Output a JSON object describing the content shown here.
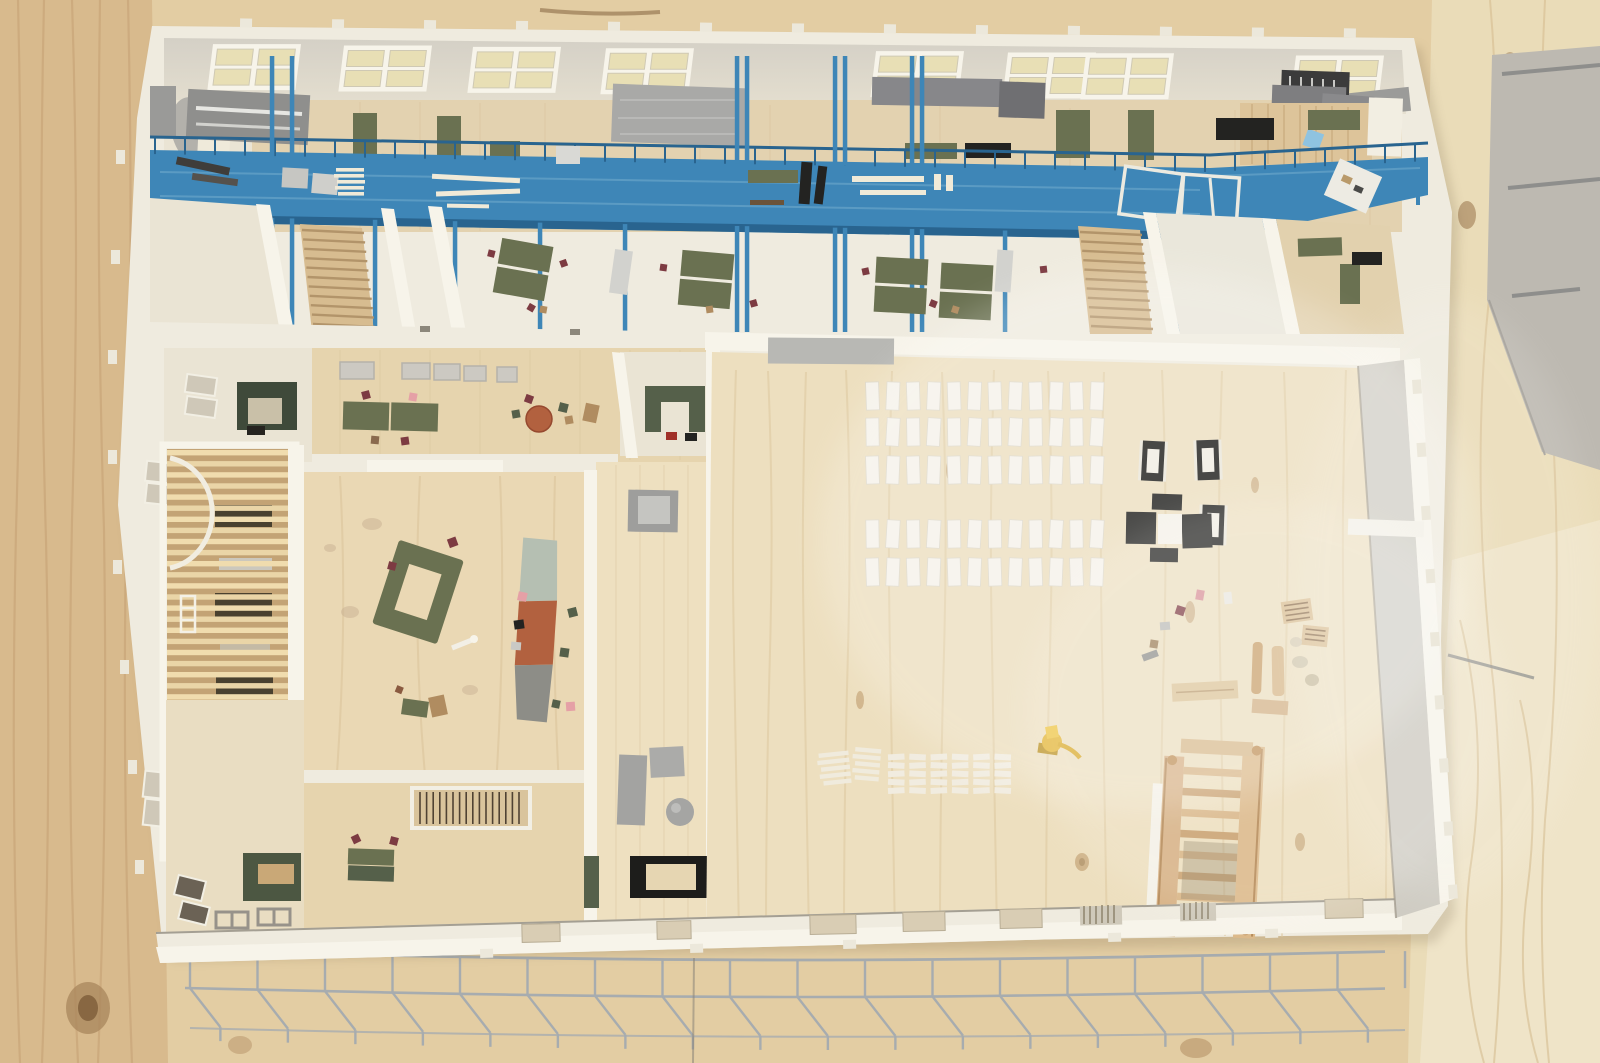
{
  "scene": {
    "subject": "architectural scale model of an elongated building, photographed top-down",
    "setting": "model laid on a knotty pine work table, gray mat-board sheet and metal rods at upper right, welded wire truss along the bottom edge",
    "palette": {
      "table": "#e3cda3",
      "table_left": "#d8ba8d",
      "table_right": "#eadcb8",
      "table_pale": "#efe4c8",
      "grain": "#c19a6e",
      "wall": "#efebdf",
      "wall_bright": "#f7f4ea",
      "wall_shadow": "#d8d3c4",
      "floor": "#e6d4ae",
      "floor_pale": "#eee0c0",
      "floor_white": "#eae4d4",
      "ceiling": "#d8d4ca",
      "skylight": "#e8dfb5",
      "blue": "#3e86b7",
      "blue_dark": "#29648f",
      "blue_light": "#6fa9cc",
      "olive": "#6a7151",
      "olive_dark": "#55604a",
      "gray_box": "#a6a6a3",
      "gray_dark": "#84848a",
      "gray_face": "#cfccc3",
      "black": "#232321",
      "terracotta": "#b2613f",
      "sage": "#b5bfb2",
      "counter_gray": "#8d8d87",
      "red_chair": "#7d3b42",
      "pink": "#e5a0a6",
      "tan": "#b08c60",
      "truss": "#a7acaf",
      "stair_wood": "#d7b286",
      "stair_wood_dark": "#b58a58",
      "yellow": "#e2b22e",
      "board": "#bdb9b1"
    },
    "counts": {
      "skylight_groups": 8,
      "louver_slats": 37,
      "louver_openings": 4,
      "audience_rows": [
        12,
        12,
        12,
        12,
        12
      ],
      "plank_grid": {
        "cols": 6,
        "rows": 5
      },
      "truss_bays": 18,
      "stair_fan_steps": 11,
      "stair_balusters": 16,
      "stair_tower_rungs": 8,
      "catwalk_columns": 16,
      "catwalk_tall_posts": 8
    },
    "objects": [
      "pine table surface with knots and grain",
      "white museum-board building shell with joint tabs",
      "skylight strips along top wing",
      "gray HVAC boxes and foam volumes",
      "blue painted steel catwalk with railings, posts and lumber on deck",
      "workshop rooms with olive desks and tiny red chairs",
      "two fan staircases",
      "timber louver roof over atrium with dark openings",
      "lounge with olive ring sofa and organic reception counter (sage, terracotta, gray)",
      "round terracotta cafe table",
      "stone-gray pedestal blocks and cylinder",
      "large event-hall floor of raw pine",
      "five rows of small white chair blocks",
      "black picture-frame tables and black cross arrangement",
      "scattered miniature pallets, dowels, planks and figures",
      "yellow toy excavator",
      "grid of small white planks",
      "wooden staircase study model standing in hall",
      "bottom facade wall with window cutouts",
      "galvanized wire truss canopy along bottom",
      "gray mat-board and steel rods at top right"
    ]
  }
}
